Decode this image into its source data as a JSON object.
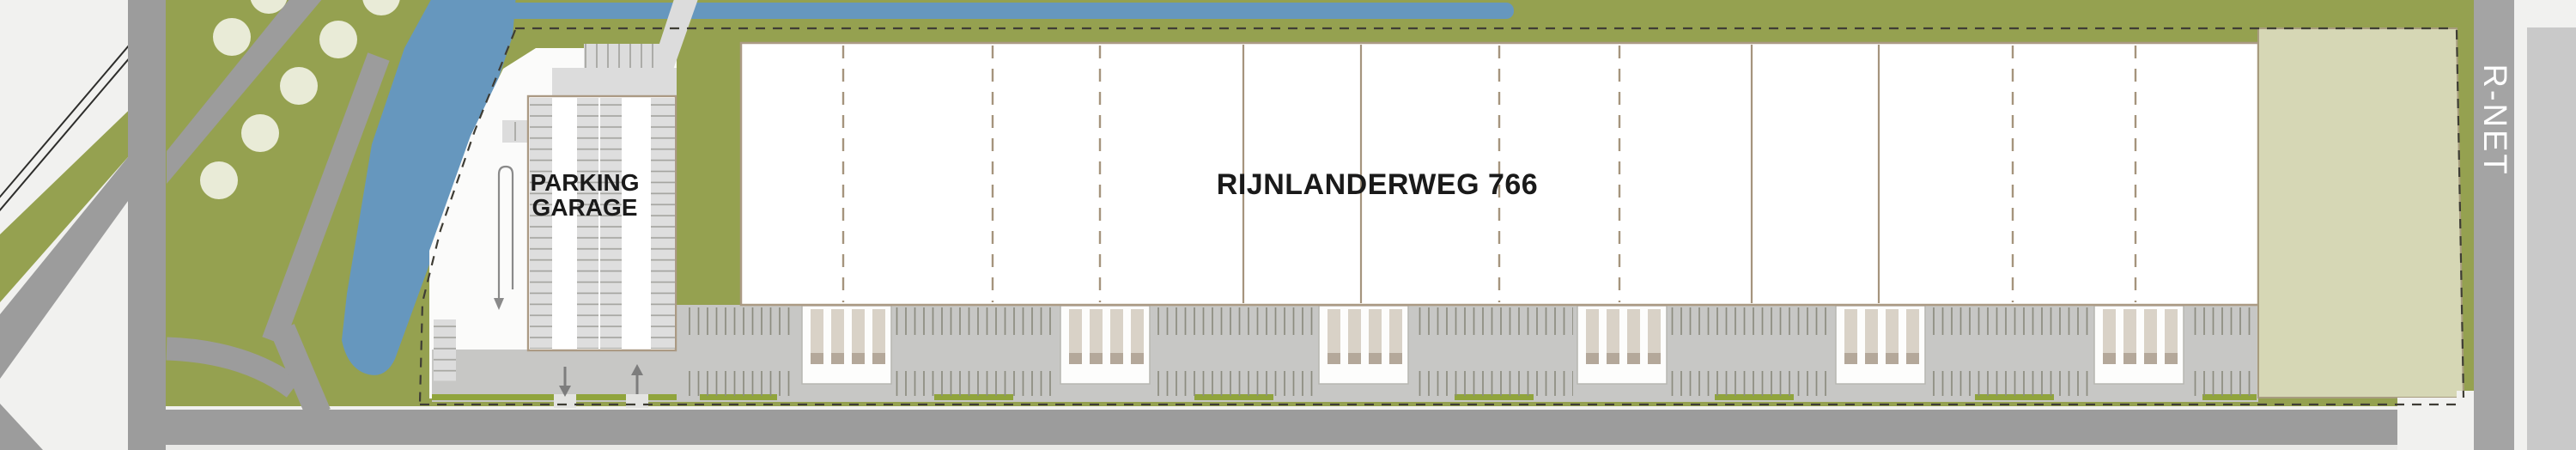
{
  "plan": {
    "building": {
      "label": "RIJNLANDERWEG 766",
      "sections_total": 12,
      "dashed_dividers": 7,
      "solid_dividers": 4
    },
    "garage": {
      "label_line1": "PARKING",
      "label_line2": "GARAGE",
      "stall_columns": 3
    },
    "transit": {
      "label": "R-NET"
    },
    "loading": {
      "dock_bays": 6,
      "truck_slots_per_bay": 4
    },
    "landscape": {
      "trees": 7,
      "hedge_strips": 10
    },
    "colors": {
      "grass": "#95a150",
      "water": "#6697be",
      "road": "#9c9c9c",
      "dock_apron": "#c7c7c5",
      "building_fill": "#ffffff",
      "building_outline": "#ab9a84",
      "beige_parcel": "#d6d7b5",
      "hedge": "#90a43c",
      "tree": "#e9ebd7",
      "boundary_dash": "#3f3d35",
      "label_text": "#1a1a1a",
      "rnet_text": "#ffffff"
    }
  }
}
